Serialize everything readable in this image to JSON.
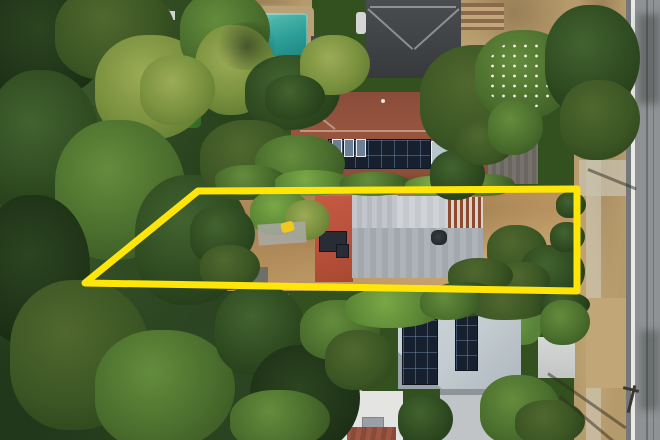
{
  "image": {
    "kind": "aerial-photograph",
    "description": "Drone aerial view of a suburban block: a bright yellow outline marks the battle-axe lot boundary around a dwelling with a red flat roof and grey metal roof, surrounded by dense tree canopy, a neighbouring red-tile-roof house with rooftop solar panels, a teal swimming pool, a rear house with solar panels, and a road with painted edge line on the right."
  },
  "boundary": {
    "points": "198,191 577,189 577,291 85,283",
    "stroke_width": 7
  },
  "colors": {
    "boundary-yellow": "#ffe608",
    "pool-teal": "#2f9f98",
    "red-tile-roof": "#8f4f3c",
    "flat-red-roof": "#bf5540",
    "metal-roof-grey": "#b4b8bd",
    "solar-panel-navy": "#16202e",
    "road-asphalt": "#8f9295",
    "dry-grass-tan": "#b59a6b",
    "canopy-green": "#33501f"
  },
  "scene": {
    "features": [
      "dense tree canopy",
      "teal swimming pool",
      "neighbouring house with red tile roof and solar array",
      "outlined lot with red flat roof and grey metal roof dwelling",
      "rear house with rooftop solar panels",
      "street with white edge line, grass verge and footpath",
      "power pole shadows on verge"
    ]
  }
}
